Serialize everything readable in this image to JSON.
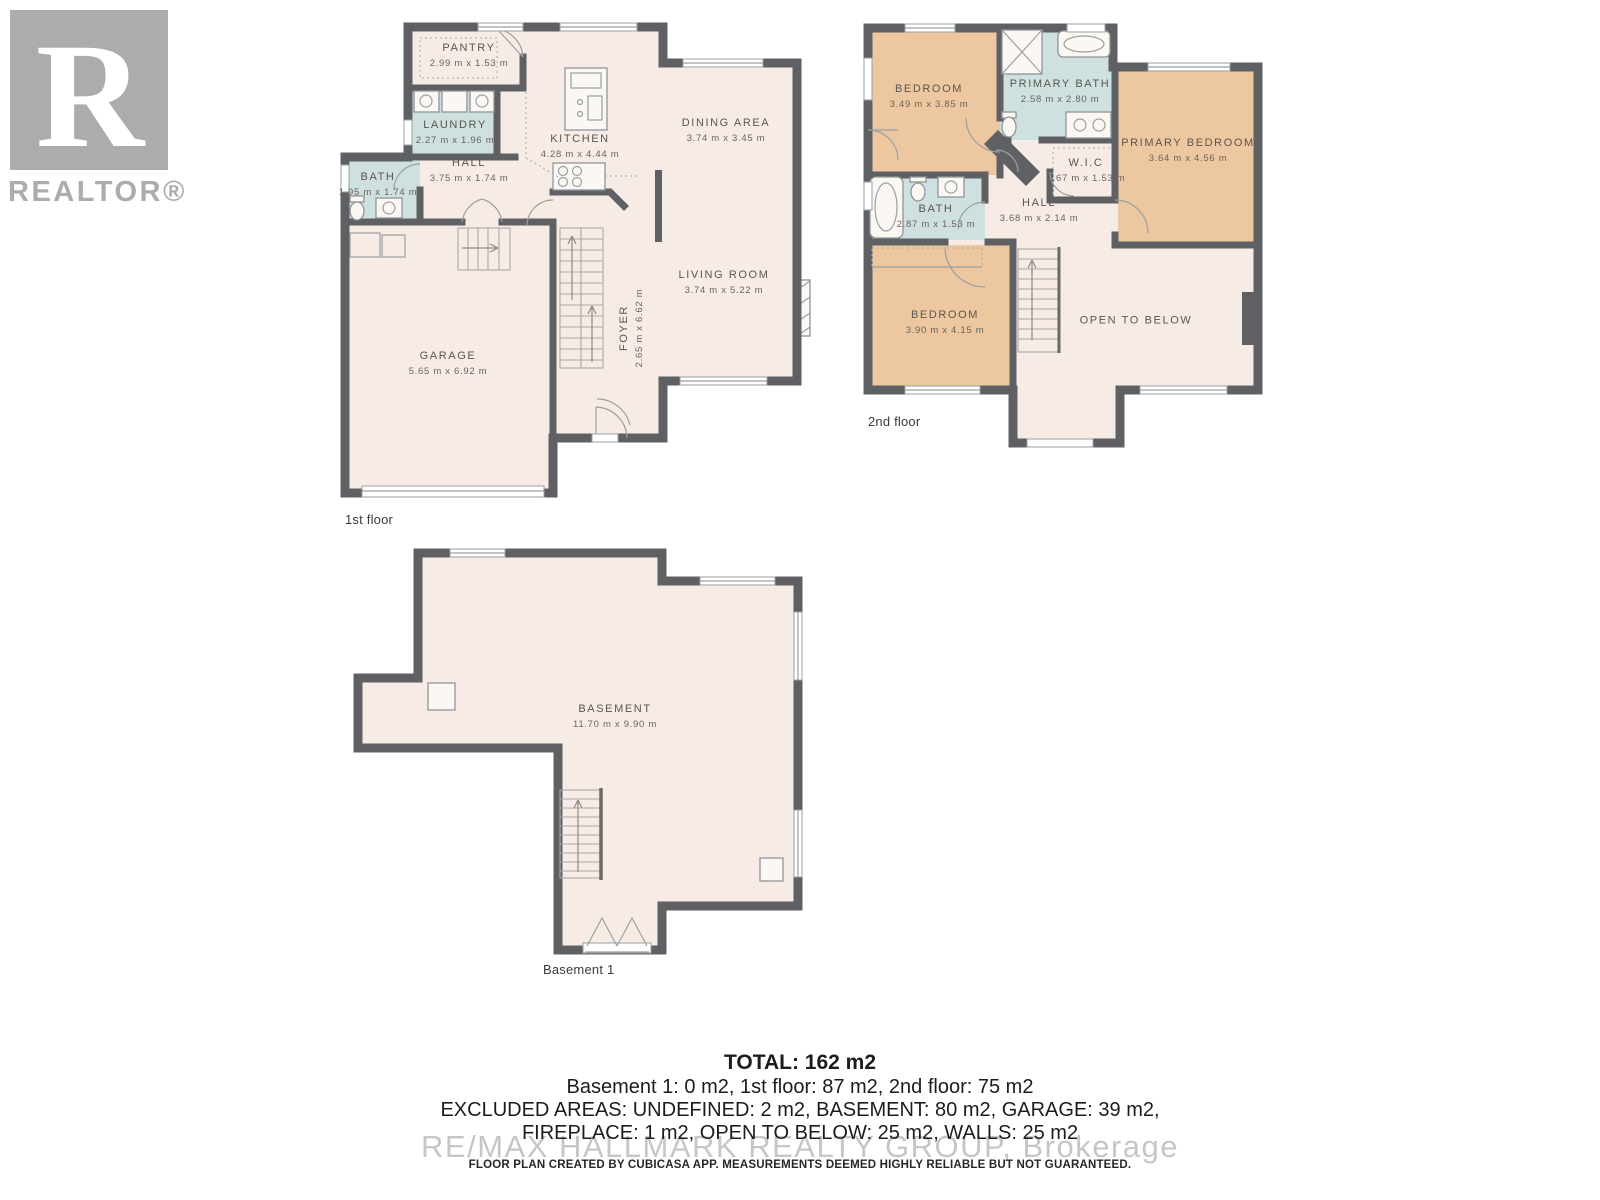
{
  "branding": {
    "logo_letter": "R",
    "logo_name": "REALTOR®"
  },
  "floors": [
    {
      "label": "1st floor",
      "rooms": [
        {
          "name": "PANTRY",
          "dims": "2.99 m x 1.53 m"
        },
        {
          "name": "LAUNDRY",
          "dims": "2.27 m x 1.96 m"
        },
        {
          "name": "BATH",
          "dims": "1.95 m x 1.74 m"
        },
        {
          "name": "HALL",
          "dims": "3.75 m x 1.74 m"
        },
        {
          "name": "KITCHEN",
          "dims": "4.28 m x 4.44 m"
        },
        {
          "name": "DINING AREA",
          "dims": "3.74 m x 3.45 m"
        },
        {
          "name": "LIVING ROOM",
          "dims": "3.74 m x 5.22 m"
        },
        {
          "name": "FOYER",
          "dims": "2.65 m x 6.62 m"
        },
        {
          "name": "GARAGE",
          "dims": "5.65 m x 6.92 m"
        }
      ]
    },
    {
      "label": "2nd floor",
      "rooms": [
        {
          "name": "BEDROOM",
          "dims": "3.49 m x 3.85 m"
        },
        {
          "name": "PRIMARY BATH",
          "dims": "2.58 m x 2.80 m"
        },
        {
          "name": "PRIMARY BEDROOM",
          "dims": "3.64 m x 4.56 m"
        },
        {
          "name": "W.I.C",
          "dims": "1.67 m x 1.53 m"
        },
        {
          "name": "BATH",
          "dims": "2.87 m x 1.53 m"
        },
        {
          "name": "HALL",
          "dims": "3.68 m x 2.14 m"
        },
        {
          "name": "BEDROOM",
          "dims": "3.90 m x 4.15 m"
        },
        {
          "name": "OPEN TO BELOW",
          "dims": ""
        }
      ]
    },
    {
      "label": "Basement 1",
      "rooms": [
        {
          "name": "BASEMENT",
          "dims": "11.70 m x 9.90 m"
        }
      ]
    }
  ],
  "summary": {
    "total": "TOTAL: 162 m2",
    "line1": "Basement 1: 0 m2, 1st floor: 87 m2, 2nd floor: 75 m2",
    "line2": "EXCLUDED AREAS: UNDEFINED: 2 m2, BASEMENT: 80 m2, GARAGE: 39 m2,",
    "line3": "FIREPLACE: 1 m2, OPEN TO BELOW: 25 m2, WALLS: 25 m2",
    "watermark": "RE/MAX HALLMARK REALTY GROUP, Brokerage",
    "disclaimer": "FLOOR PLAN CREATED BY CUBICASA APP. MEASUREMENTS DEEMED HIGHLY RELIABLE BUT NOT GUARANTEED."
  },
  "colors": {
    "wall": "#5f6063",
    "floor": "#f7ece5",
    "wet_room": "#cee0df",
    "bedroom": "#edc7a0",
    "logo_gray": "#acacac",
    "watermark_gray": "#c6c6c6"
  }
}
